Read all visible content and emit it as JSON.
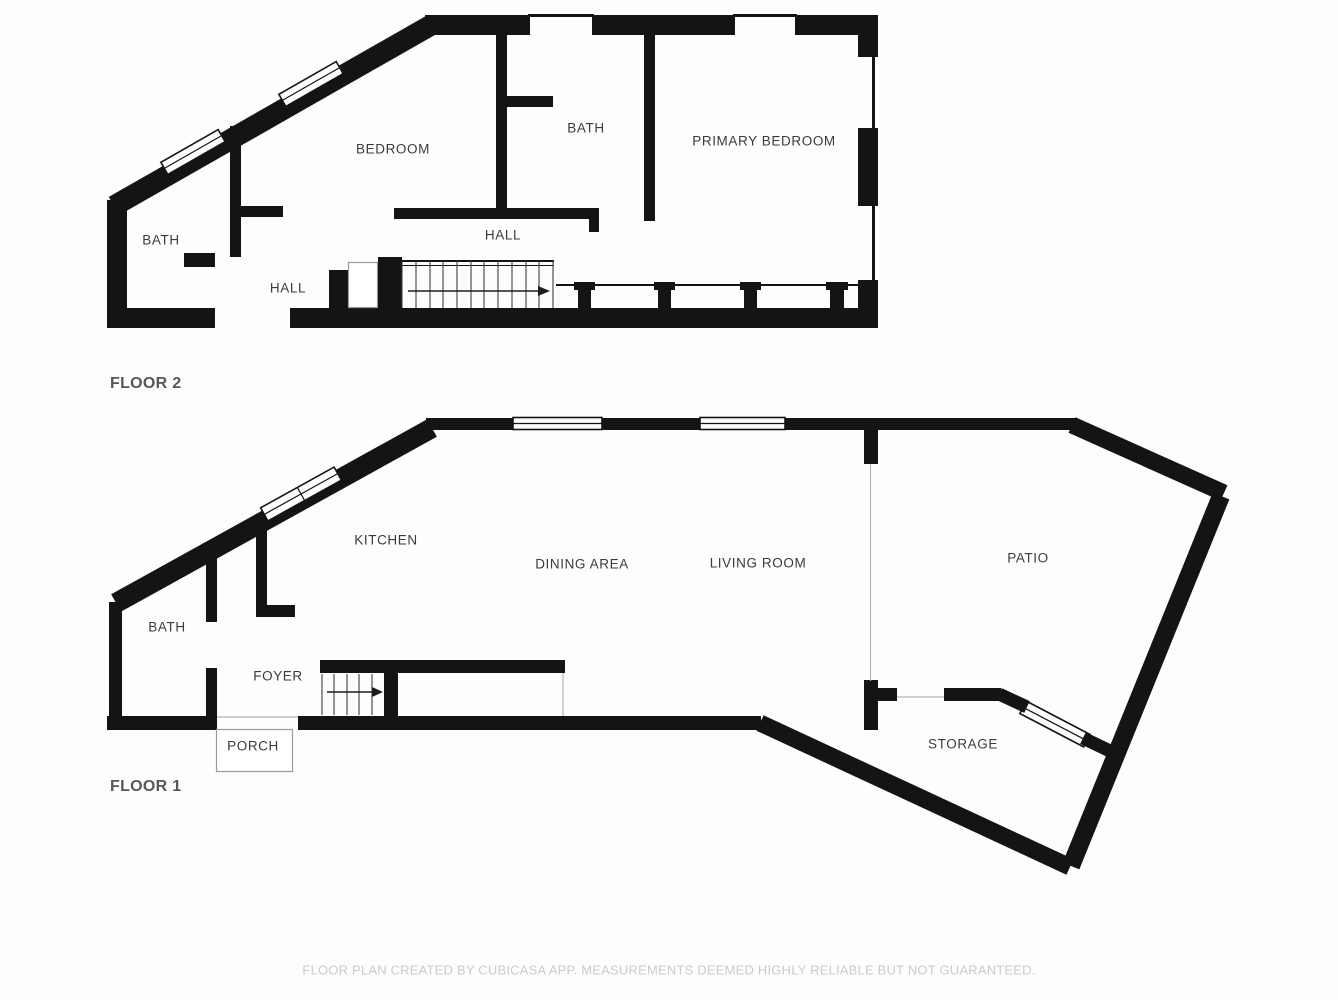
{
  "colors": {
    "wall": "#141414",
    "bg": "#fdfdfd",
    "room_label": "#3b3b3b",
    "floor_label": "#575757",
    "disclaimer": "#cbcbcb",
    "open_edge": "#b5b5b5",
    "stair_line": "#3f3f3f"
  },
  "floor2": {
    "label": "FLOOR 2",
    "rooms": {
      "bath_left": "BATH",
      "bedroom": "BEDROOM",
      "bath_mid": "BATH",
      "primary_bedroom": "PRIMARY BEDROOM",
      "hall_upper": "HALL",
      "hall_lower": "HALL"
    }
  },
  "floor1": {
    "label": "FLOOR 1",
    "rooms": {
      "kitchen": "KITCHEN",
      "dining_area": "DINING AREA",
      "living_room": "LIVING ROOM",
      "patio": "PATIO",
      "bath": "BATH",
      "foyer": "FOYER",
      "porch": "PORCH",
      "storage": "STORAGE"
    }
  },
  "footer": {
    "disclaimer": "FLOOR PLAN CREATED BY CUBICASA APP. MEASUREMENTS DEEMED HIGHLY RELIABLE BUT NOT GUARANTEED."
  }
}
